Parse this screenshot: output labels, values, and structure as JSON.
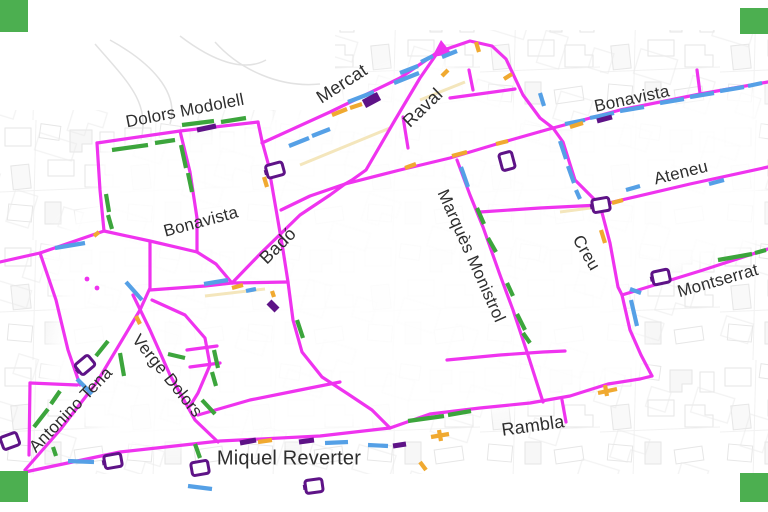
{
  "slide": {
    "corner_marker_color": "#4caf50",
    "background": "#ffffff"
  },
  "map": {
    "street_labels": {
      "dolors_modolell": "Dolors Modolell",
      "mercat": "Mercat",
      "raval": "Raval",
      "bonavista_top": "Bonavista",
      "ateneu": "Ateneu",
      "montserrat": "Montserrat",
      "creu": "Creu",
      "marques_monistrol": "Marquès Monistrol",
      "bonavista_left": "Bonavista",
      "bado": "Badó",
      "verge_dolors": "Verge Dolors",
      "antonino_tena": "Antonino Tena",
      "miquel_reverter": "Miquel Reverter",
      "rambla": "Rambla"
    },
    "colors": {
      "street": "#ef33ef",
      "green_marks": "#3ca53c",
      "blue_marks": "#55a0e6",
      "orange_marks": "#f0a930",
      "purple_marks": "#5e1387",
      "label_text": "#2e2e2e",
      "basemap_lines": "#dcdcdc",
      "corner_squares": "#4caf50"
    },
    "icons": [
      "parking-sign-icon",
      "direction-arrow-icon",
      "corner-marker"
    ]
  }
}
